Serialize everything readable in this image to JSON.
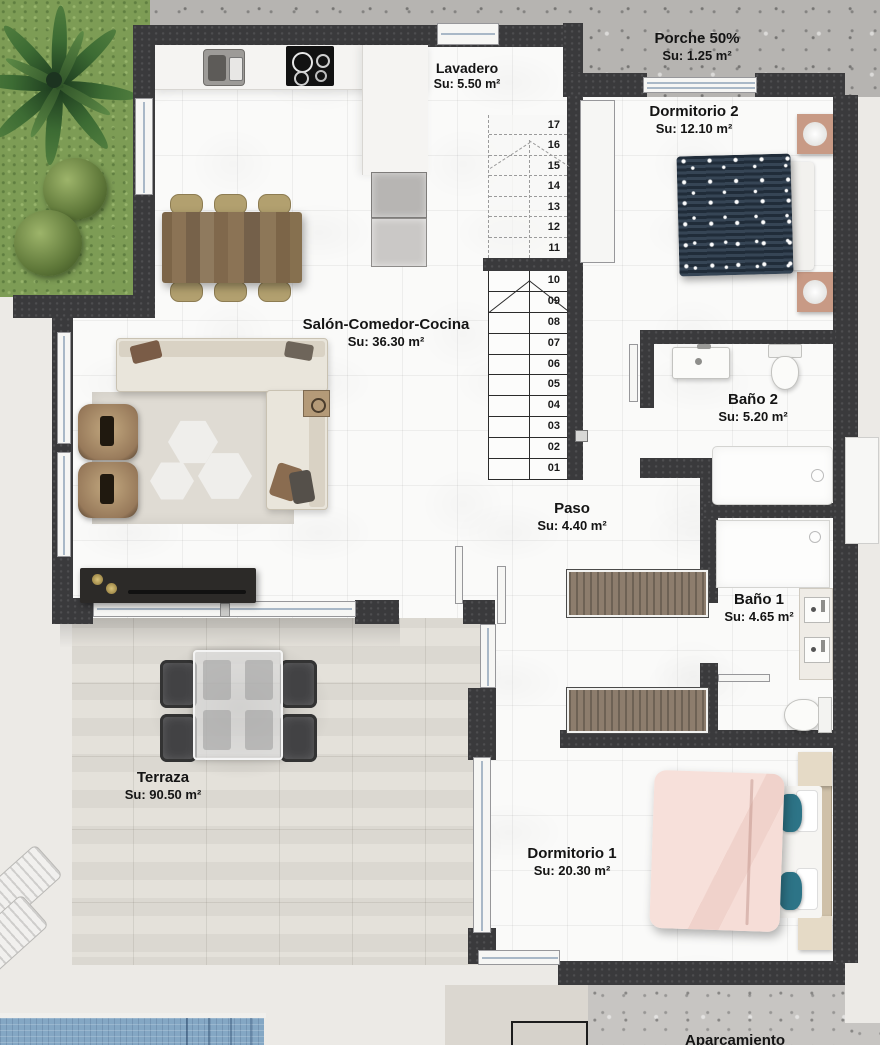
{
  "plan": {
    "title": "Planta vivienda",
    "rooms": [
      {
        "name": "Porche 50%",
        "area": "Su: 1.25 m²"
      },
      {
        "name": "Lavadero",
        "area": "Su: 5.50 m²"
      },
      {
        "name": "Dormitorio 2",
        "area": "Su: 12.10 m²"
      },
      {
        "name": "Salón-Comedor-Cocina",
        "area": "Su: 36.30 m²"
      },
      {
        "name": "Baño 2",
        "area": "Su: 5.20 m²"
      },
      {
        "name": "Paso",
        "area": "Su: 4.40 m²"
      },
      {
        "name": "Baño 1",
        "area": "Su: 4.65 m²"
      },
      {
        "name": "Dormitorio 1",
        "area": "Su: 20.30 m²"
      },
      {
        "name": "Terraza",
        "area": "Su: 90.50 m²"
      },
      {
        "name": "Aparcamiento",
        "area": ""
      }
    ],
    "stairs": {
      "steps": [
        "17",
        "16",
        "15",
        "14",
        "13",
        "12",
        "11",
        "10",
        "09",
        "08",
        "07",
        "06",
        "05",
        "04",
        "03",
        "02",
        "01"
      ]
    },
    "colors": {
      "wall": "#3a3a3c",
      "floor": "#fafaf9",
      "grass": "#7d9c55",
      "pool": "#84a7c4",
      "concrete": "#b6b4b1",
      "terrace": "#eceae6",
      "bed2": "#2b3b4c",
      "bed1_duvet": "#f6ddd8",
      "wood": "#8b7355"
    }
  }
}
